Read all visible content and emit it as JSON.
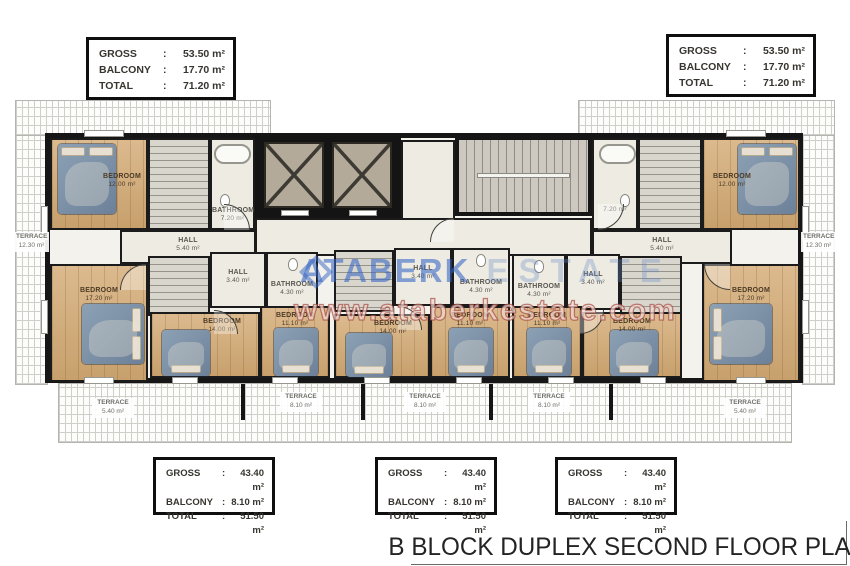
{
  "title_block": {
    "title": "B BLOCK DUPLEX SECOND FLOOR PLAN"
  },
  "watermark": {
    "brand": "ATABERK",
    "brand_suffix": "ESTATE",
    "url": "www.ataberkestate.com"
  },
  "info_boxes": {
    "duplex_large": {
      "rows": [
        {
          "label": "GROSS",
          "sep": ":",
          "value": "53.50 m²"
        },
        {
          "label": "BALCONY",
          "sep": ":",
          "value": "17.70 m²"
        },
        {
          "label": "TOTAL",
          "sep": ":",
          "value": "71.20 m²"
        }
      ]
    },
    "duplex_small": {
      "rows": [
        {
          "label": "GROSS",
          "sep": ":",
          "value": "43.40 m²"
        },
        {
          "label": "BALCONY",
          "sep": ":",
          "value": "8.10 m²"
        },
        {
          "label": "TOTAL",
          "sep": ":",
          "value": "51.50 m²"
        }
      ]
    }
  },
  "rooms": {
    "bedroom_12_left": {
      "name": "BEDROOM",
      "area": "12.00 m²"
    },
    "bedroom_12_right": {
      "name": "BEDROOM",
      "area": "12.00 m²"
    },
    "bathroom_72_left": {
      "name": "BATHROOM",
      "area": "7.20 m²"
    },
    "bathroom_72_right": {
      "name": "",
      "area": "7.20 m²"
    },
    "hall_54_left": {
      "name": "HALL",
      "area": "5.40 m²"
    },
    "hall_54_right": {
      "name": "HALL",
      "area": "5.40 m²"
    },
    "bedroom_172_left": {
      "name": "BEDROOM",
      "area": "17.20 m²"
    },
    "bedroom_172_right": {
      "name": "BEDROOM",
      "area": "17.20 m²"
    },
    "terrace_123_left": {
      "name": "TERRACE",
      "area": "12.30 m²"
    },
    "terrace_123_right": {
      "name": "TERRACE",
      "area": "12.30 m²"
    },
    "hall_34_a": {
      "name": "HALL",
      "area": "3.40 m²"
    },
    "hall_34_b": {
      "name": "HALL",
      "area": "3.40 m²"
    },
    "hall_34_c": {
      "name": "HALL",
      "area": "3.40 m²"
    },
    "bath_43_a": {
      "name": "BATHROOM",
      "area": "4.30 m²"
    },
    "bath_43_b": {
      "name": "BATHROOM",
      "area": "4.30 m²"
    },
    "bath_43_c": {
      "name": "BATHROOM",
      "area": "4.30 m²"
    },
    "bedroom_14_a": {
      "name": "BEDROOM",
      "area": "14.00 m²"
    },
    "bedroom_14_b": {
      "name": "BEDROOM",
      "area": "14.00 m²"
    },
    "bedroom_14_c": {
      "name": "BEDROOM",
      "area": "14.00 m²"
    },
    "bedroom_111_a": {
      "name": "BEDROOM",
      "area": "11.10 m²"
    },
    "bedroom_111_b": {
      "name": "BEDROOM",
      "area": "11.10 m²"
    },
    "bedroom_111_c": {
      "name": "BEDROOM",
      "area": "11.10 m²"
    },
    "terrace_54_left": {
      "name": "TERRACE",
      "area": "5.40 m²"
    },
    "terrace_54_right": {
      "name": "TERRACE",
      "area": "5.40 m²"
    },
    "terrace_81_a": {
      "name": "TERRACE",
      "area": "8.10 m²"
    },
    "terrace_81_b": {
      "name": "TERRACE",
      "area": "8.10 m²"
    },
    "terrace_81_c": {
      "name": "TERRACE",
      "area": "8.10 m²"
    }
  },
  "colors": {
    "wall": "#161616",
    "wood_floor": "#d2b086",
    "tile_floor": "#edebe2",
    "bed": "#7e92a8",
    "roof_hatch_line": "#cfcfca",
    "watermark_blue": "#3464c4",
    "watermark_red": "#9e3e32"
  }
}
